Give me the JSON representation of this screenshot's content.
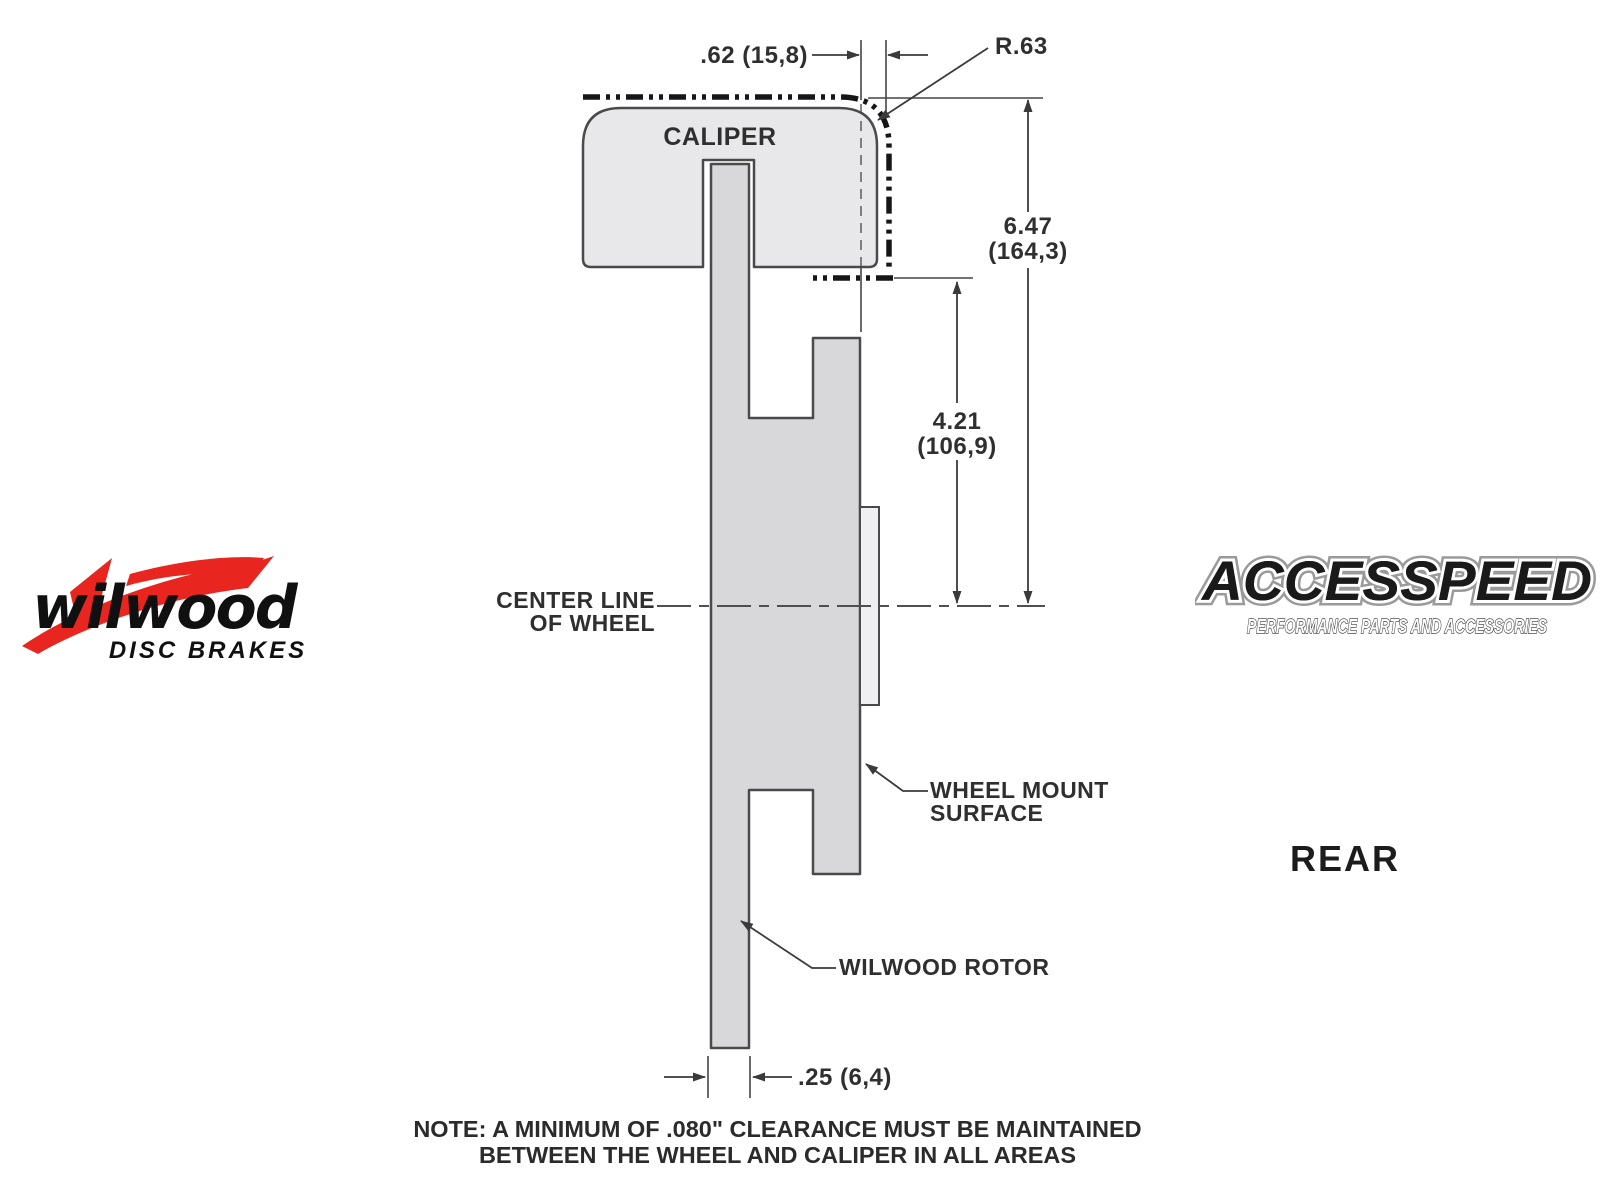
{
  "diagram": {
    "caliper_label": "CALIPER",
    "centerline_label": {
      "line1": "CENTER LINE",
      "line2": "OF WHEEL"
    },
    "wheel_mount_label": {
      "line1": "WHEEL MOUNT",
      "line2": "SURFACE"
    },
    "rotor_label": "WILWOOD ROTOR",
    "view_label": "REAR",
    "dimensions": {
      "caliper_overhang": ".62 (15,8)",
      "corner_radius": "R.63",
      "caliper_top_to_centerline_in": "6.47",
      "caliper_top_to_centerline_mm": "(164,3)",
      "mount_step_to_centerline_in": "4.21",
      "mount_step_to_centerline_mm": "(106,9)",
      "rotor_thickness": ".25 (6,4)"
    },
    "note": {
      "line1": "NOTE: A MINIMUM OF .080\" CLEARANCE MUST BE MAINTAINED",
      "line2": "BETWEEN THE WHEEL AND CALIPER IN ALL AREAS"
    },
    "colors": {
      "caliper_fill": "#e8e8ea",
      "rotor_fill": "#d8d8da",
      "mount_plate_fill": "#efeff1",
      "outline": "#4a4a4a",
      "wheel_dash_line": "#161616",
      "logo_red": "#e8251f"
    }
  },
  "logos": {
    "wilwood": {
      "wordmark": "wilwood",
      "tagline": "DISC BRAKES"
    },
    "accesspeed": {
      "wordmark": "ACCESSPEED",
      "tagline": "PERFORMANCE PARTS AND ACCESSORIES"
    }
  }
}
